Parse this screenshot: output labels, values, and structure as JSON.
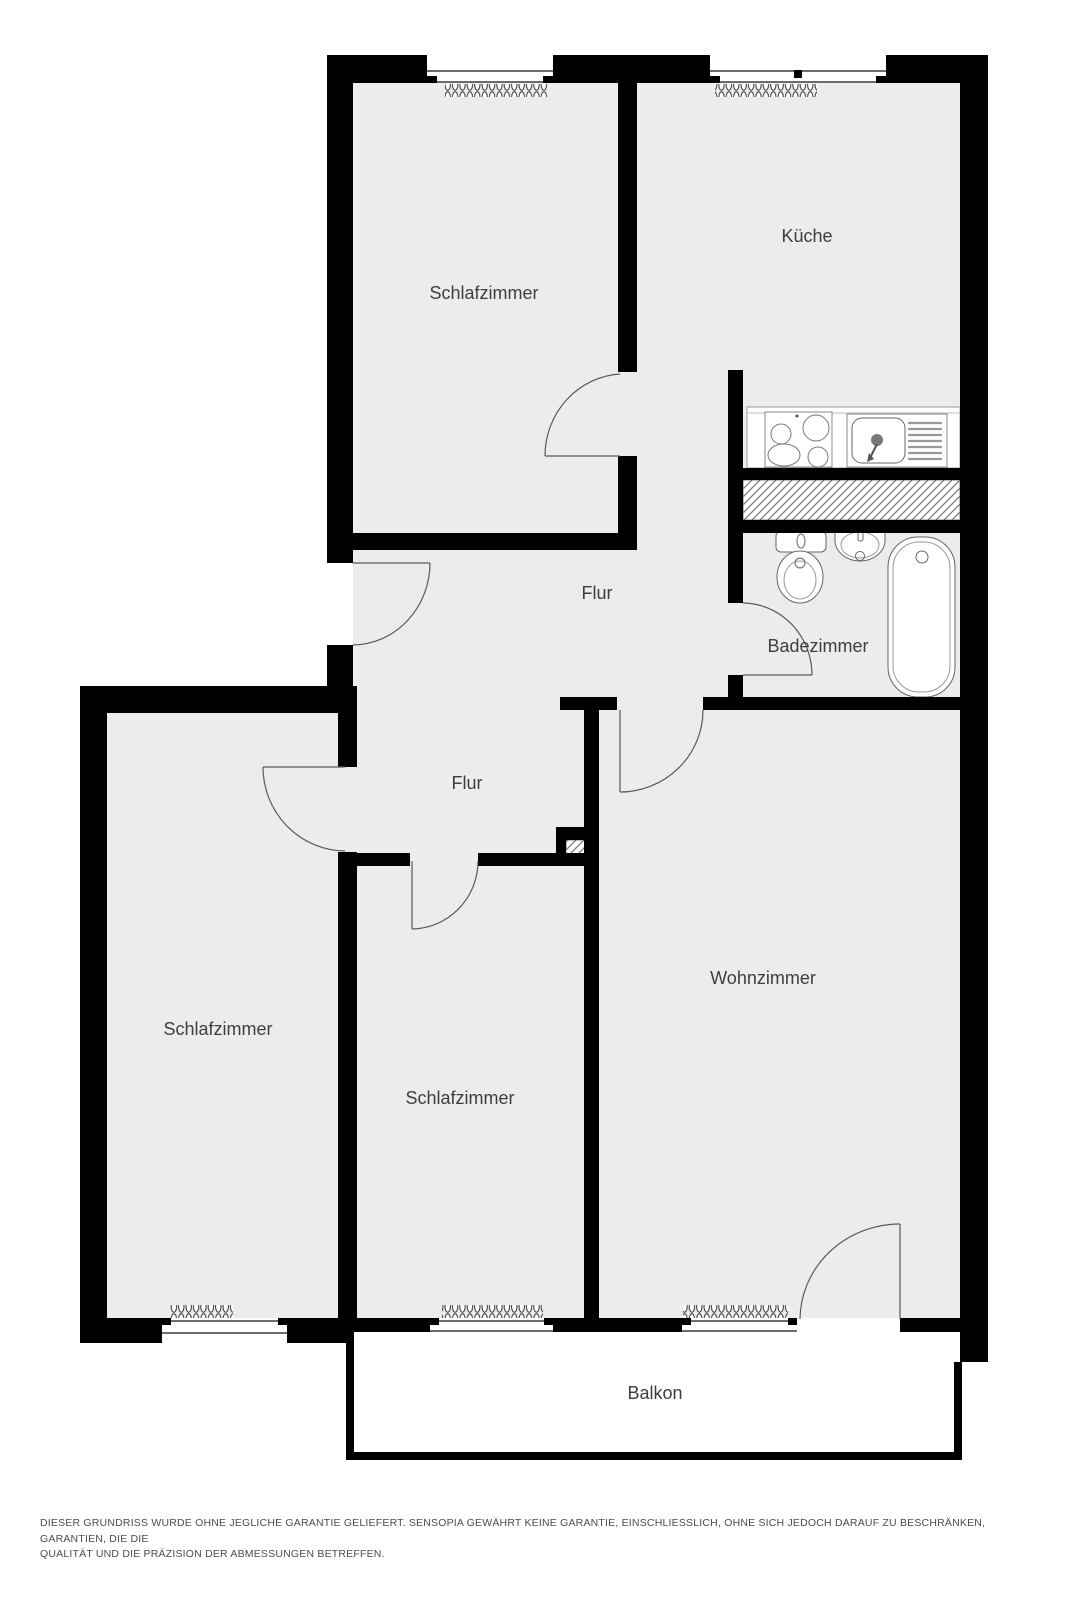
{
  "rooms": [
    {
      "id": "schlafzimmer-top",
      "label": "Schlafzimmer"
    },
    {
      "id": "kueche",
      "label": "Küche"
    },
    {
      "id": "flur-oben",
      "label": "Flur"
    },
    {
      "id": "badezimmer",
      "label": "Badezimmer"
    },
    {
      "id": "flur-unten",
      "label": "Flur"
    },
    {
      "id": "schlafzimmer-links",
      "label": "Schlafzimmer"
    },
    {
      "id": "schlafzimmer-mitte",
      "label": "Schlafzimmer"
    },
    {
      "id": "wohnzimmer",
      "label": "Wohnzimmer"
    },
    {
      "id": "balkon",
      "label": "Balkon"
    }
  ],
  "disclaimer": {
    "line1": "DIESER GRUNDRISS WURDE OHNE JEGLICHE GARANTIE GELIEFERT. SENSOPIA GEWÄHRT KEINE GARANTIE, EINSCHLIESSLICH, OHNE SICH JEDOCH DARAUF ZU BESCHRÄNKEN, GARANTIEN, DIE DIE",
    "line2": "QUALITÄT UND DIE PRÄZISION DER ABMESSUNGEN BETREFFEN."
  },
  "colors": {
    "wall": "#000000",
    "floor": "#ECECEC",
    "label_text": "#3E3E3E",
    "fixture_line": "#666666",
    "disclaimer_text": "#4C4C4C"
  }
}
